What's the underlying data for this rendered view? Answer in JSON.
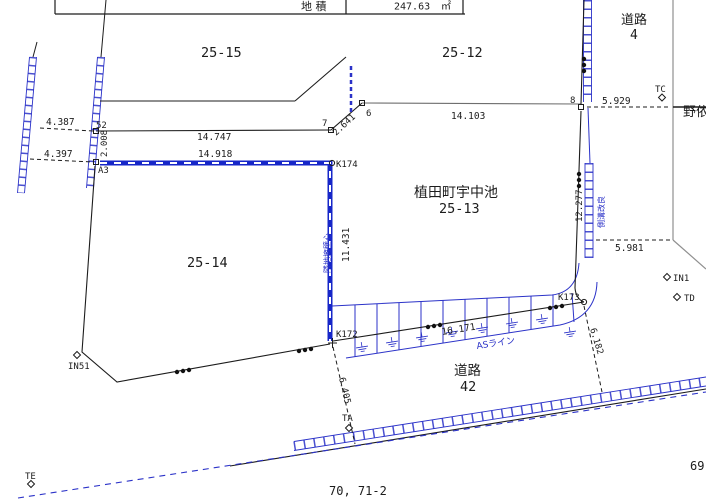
{
  "table": {
    "area_label": "地 積",
    "area_value": "247.63",
    "area_unit": "㎡"
  },
  "parcels": {
    "p2515": "25-15",
    "p2512": "25-12",
    "road4_name": "道路",
    "road4_num": "4",
    "offsite_right": "野依",
    "chiban_title": "植田町宇中池",
    "p2513": "25-13",
    "p2514": "25-14",
    "road42_name": "道路",
    "road42_num": "42",
    "bottom_parcel": "70, 71-2",
    "right_parcel": "69"
  },
  "points": {
    "p52": "52",
    "p7": "7",
    "p6": "6",
    "p8": "8",
    "a3": "A3",
    "k174": "K174",
    "k173": "K173",
    "k172": "K172",
    "tc": "TC",
    "in1": "IN1",
    "td": "TD",
    "in51": "IN51",
    "ta": "TA",
    "te": "TE"
  },
  "measurements": {
    "m4387": "4.387",
    "m4397": "4.397",
    "m2008": "2.008",
    "m14747": "14.747",
    "m14918": "14.918",
    "m2641": "2.641",
    "m14103": "14.103",
    "m5929": "5.929",
    "m12277": "12.277",
    "m5981": "5.981",
    "m11431": "11.431",
    "m16171": "16.171",
    "m6182": "6.182",
    "m6405": "6.405"
  },
  "notes": {
    "as_line": "ASライン",
    "wall_note": "隣地擁壁心",
    "gutter_note": "側溝改良"
  },
  "colors": {
    "blue": "#2b32c8",
    "black": "#1c1c1c",
    "gray": "#8f8f8f",
    "background": "#ffffff"
  }
}
